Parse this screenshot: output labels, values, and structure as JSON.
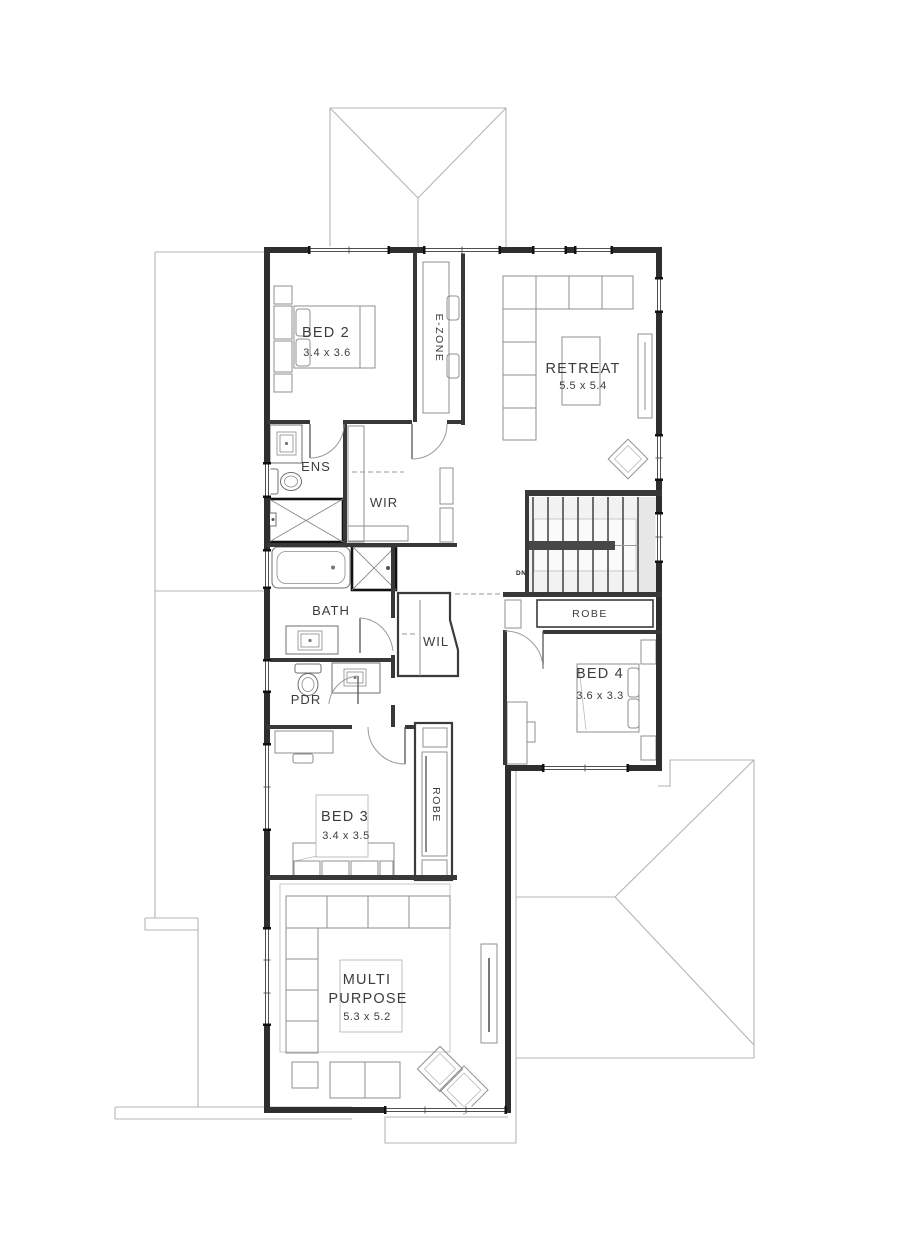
{
  "rooms": {
    "bed2": {
      "name": "BED 2",
      "dims": "3.4 x 3.6"
    },
    "retreat": {
      "name": "RETREAT",
      "dims": "5.5 x 5.4"
    },
    "ens": {
      "name": "ENS"
    },
    "wir": {
      "name": "WIR"
    },
    "bath": {
      "name": "BATH"
    },
    "wil": {
      "name": "WIL"
    },
    "pdr": {
      "name": "PDR"
    },
    "robe_bed4": {
      "name": "ROBE"
    },
    "bed4": {
      "name": "BED 4",
      "dims": "3.6 x 3.3"
    },
    "bed3": {
      "name": "BED 3",
      "dims": "3.4 x 3.5"
    },
    "robe_bed3": {
      "name": "ROBE"
    },
    "multi": {
      "line1": "MULTI",
      "line2": "PURPOSE",
      "dims": "5.3 x 5.2"
    },
    "ezone": {
      "name": "E-ZONE"
    }
  },
  "stairs": {
    "label": "DN"
  },
  "colors": {
    "wall": "#2e2e2e",
    "furniture": "#8f8f8f",
    "roof": "#b5b5b5",
    "text": "#3c3c3c"
  }
}
